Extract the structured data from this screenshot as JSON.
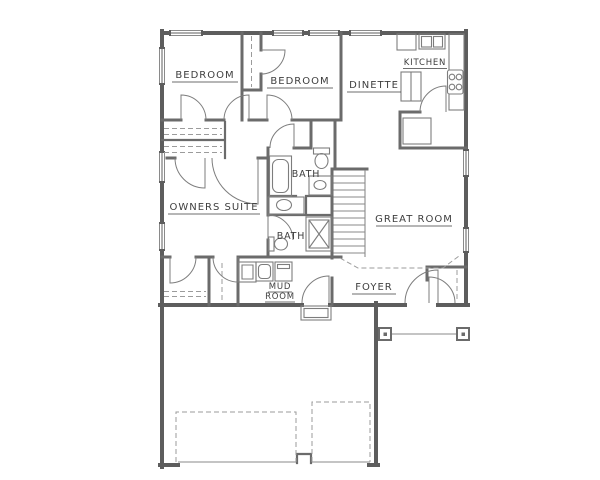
{
  "document": {
    "type": "residential-floor-plan"
  },
  "colors": {
    "background": "#ffffff",
    "wall": "#5d5d5d",
    "partition": "#6b6b6b",
    "fixture": "#7d7d7d",
    "thin": "#8a8a8a",
    "dash": "#9b9b9b",
    "hatch": "#a8a8a8",
    "text": "#3e3e3e"
  },
  "labels": {
    "bedroom_1": "BEDROOM",
    "bedroom_2": "BEDROOM",
    "dinette": "DINETTE",
    "kitchen": "KITCHEN",
    "owners_suite": "OWNERS SUITE",
    "bath_upper": "BATH",
    "bath_lower": "BATH",
    "great_room": "GREAT ROOM",
    "mud_room_line_1": "MUD",
    "mud_room_line_2": "ROOM",
    "foyer": "FOYER"
  }
}
